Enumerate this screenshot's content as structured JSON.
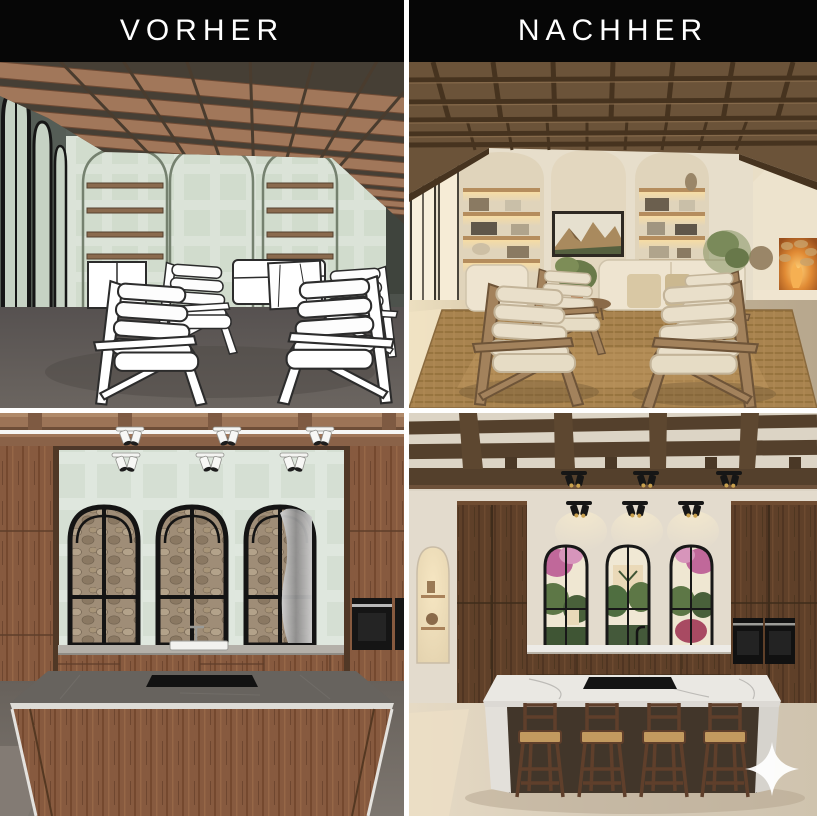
{
  "panels": {
    "top_left": {
      "label": "VORHER",
      "scene_name": "living-room-3d-draft-model"
    },
    "top_right": {
      "label": "NACHHER",
      "scene_name": "living-room-photoreal-render"
    },
    "bottom_left": {
      "scene_name": "kitchen-3d-draft-model"
    },
    "bottom_right": {
      "scene_name": "kitchen-photoreal-render"
    }
  },
  "watermark": {
    "icon": "sparkle-icon",
    "color": "#ffffff"
  },
  "palette": {
    "header_bg": "#060606",
    "header_text": "#ffffff",
    "gutter": "#ffffff",
    "draft_wall_dark": "#59615a",
    "draft_wall_mint": "#dbe3d8",
    "draft_floor": "#5e5853",
    "draft_wood_beam": "#a1775a",
    "render_wall_cream": "#e7decb",
    "render_ceiling_wood": "#5d4731",
    "render_floor_warm": "#c7b69b",
    "walnut_cabinet": "#7a4f35",
    "marble": "#eae8e3",
    "rug_jute": "#a8834f",
    "fire_glow": "#e08a34"
  }
}
